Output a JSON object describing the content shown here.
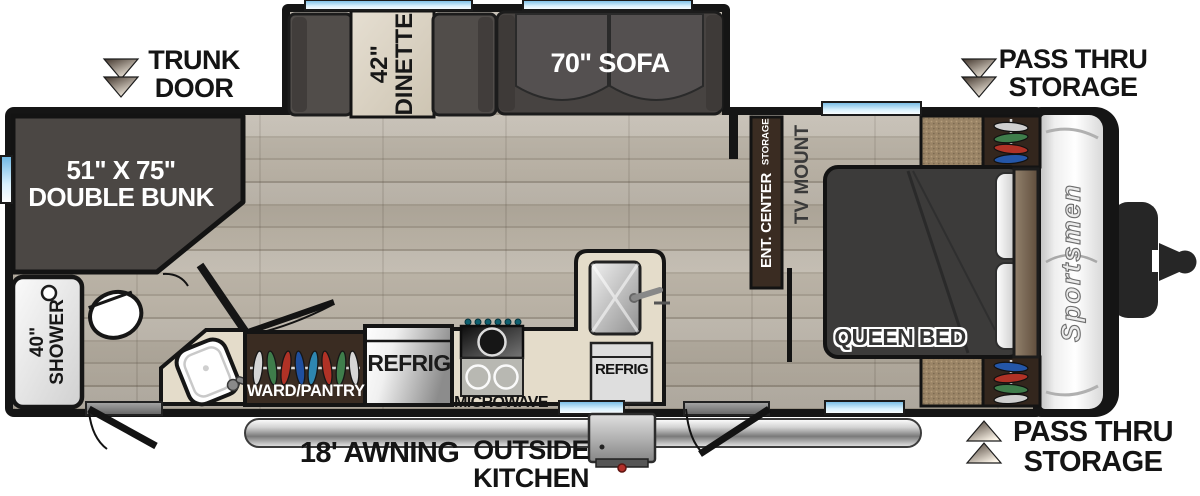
{
  "colors": {
    "wall": "#151515",
    "window_blue": "#9ed4ef",
    "floor_wood": "#b4ac9f",
    "furniture_dark_gray": "#4b4744",
    "counter_beige": "#e4dcca",
    "cabinet_brown": "#3a2c22",
    "carpet_brown": "#9a8466",
    "awning_silver": "#bdbdbd",
    "accent_red": "#b3302a"
  },
  "exterior": {
    "trunk_line1": "TRUNK",
    "trunk_line2": "DOOR",
    "pass_top_line1": "PASS THRU",
    "pass_top_line2": "STORAGE",
    "pass_bottom_line1": "PASS THRU",
    "pass_bottom_line2": "STORAGE",
    "awning": "18' AWNING",
    "ok_line1": "OUTSIDE",
    "ok_line2": "KITCHEN",
    "brand": "Sportsmen"
  },
  "interior": {
    "bunk_line1": "51\" X 75\"",
    "bunk_line2": "DOUBLE BUNK",
    "dinette_line1": "42\"",
    "dinette_line2": "DINETTE",
    "sofa": "70\" SOFA",
    "shower_line1": "40\"",
    "shower_line2": "SHOWER",
    "ward_pantry": "WARD/PANTRY",
    "refrig": "REFRIG",
    "refrig2": "REFRIG",
    "microwave": "MICROWAVE",
    "ent_center": "ENT. CENTER",
    "ent_storage": "STORAGE",
    "tv_mount": "TV MOUNT",
    "queen_bed": "QUEEN BED"
  }
}
